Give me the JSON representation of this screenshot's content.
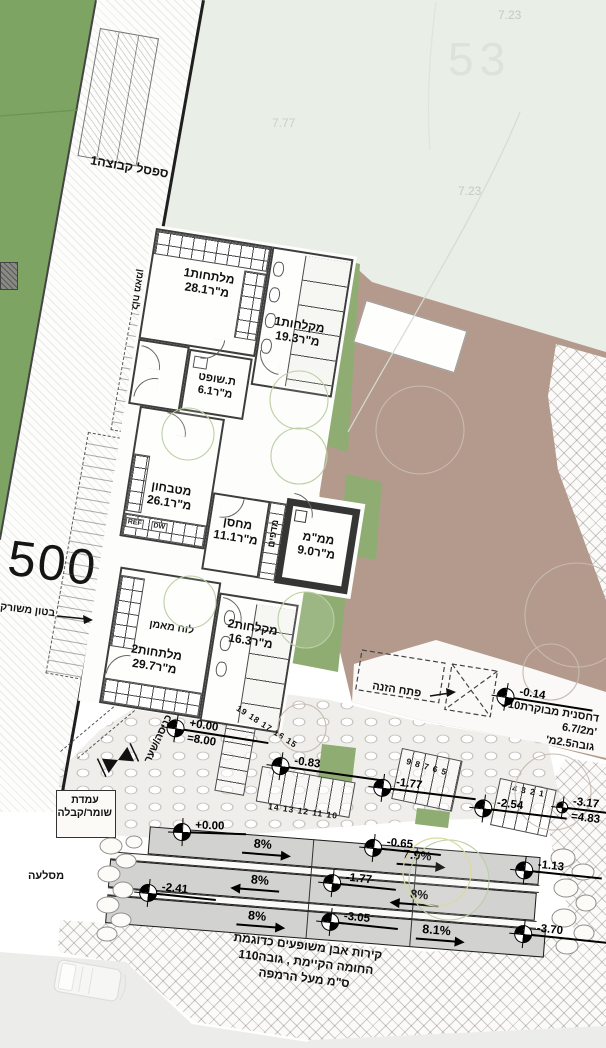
{
  "labels": {
    "contour_a": "7.23",
    "parcel_53": "53",
    "contour_b": "7.77",
    "contour_c": "7.23"
  },
  "strip": {
    "area_label": "מרחב קו חוץ לאימונים",
    "bench": "ספסל קבוצה1",
    "parcel": "500",
    "concrete": "בטון משורק"
  },
  "rooms": [
    {
      "name": "מלתחות1",
      "area": "28.1מ\"ר"
    },
    {
      "name": "מקלחות1",
      "area": "19.3מ\"ר"
    },
    {
      "name": "ת.שופט",
      "area": "6.1מ\"ר"
    },
    {
      "name": "מטבחון",
      "area": "26.1מ\"ר"
    },
    {
      "name": "מחסן",
      "area": "11.1מ\"ר"
    },
    {
      "name": "ממ\"מ",
      "area": "9.0מ\"ר"
    },
    {
      "name": "מקלחות2",
      "area": "16.3מ\"ר"
    },
    {
      "name": "מלתחות2",
      "area": "29.7מ\"ר"
    }
  ],
  "fixtures": {
    "shelves": "מדפים",
    "coach_board": "לוח מאמן",
    "ref": "REF",
    "dw": "DW"
  },
  "stairs": {
    "a": "19 18 17 16 15",
    "b": "14 13 12 11 10",
    "c": "9 8 7 6 5",
    "d": "4 3 2 1"
  },
  "markers": [
    {
      "value": "+0.00",
      "sub": "=8.00"
    },
    {
      "value": "-0.83"
    },
    {
      "value": "-1.77"
    },
    {
      "value": "-2.54"
    },
    {
      "value": "-3.17",
      "sub": "=4.83"
    },
    {
      "value": "-0.14"
    },
    {
      "value": "+0.00"
    },
    {
      "value": "-2.41"
    },
    {
      "value": "-1.77"
    },
    {
      "value": "-3.05"
    },
    {
      "value": "-0.65"
    },
    {
      "value": "-1.13"
    },
    {
      "value": "-3.70"
    }
  ],
  "slopes": [
    {
      "value": "8%"
    },
    {
      "value": "7.9%"
    },
    {
      "value": "8%"
    },
    {
      "value": "8%"
    },
    {
      "value": "8%"
    },
    {
      "value": "8.1%"
    }
  ],
  "entry": {
    "gate": "כניסה/שער",
    "guard_1": "עמדת",
    "guard_2": "שומר/קבלה",
    "rockery": "מסלעה"
  },
  "compactor": {
    "feed": "פתח הזנה",
    "l1": "דחסנית מבוקרת10ט'",
    "l2": "6.7/2מ'",
    "l3": "גובה2.5מ'"
  },
  "wall_note": {
    "l1": "קירות אבן משופעים כדוגמת",
    "l2": "החומה הקיימת , גובה110",
    "l3": "ס\"מ מעל הרמפה"
  }
}
